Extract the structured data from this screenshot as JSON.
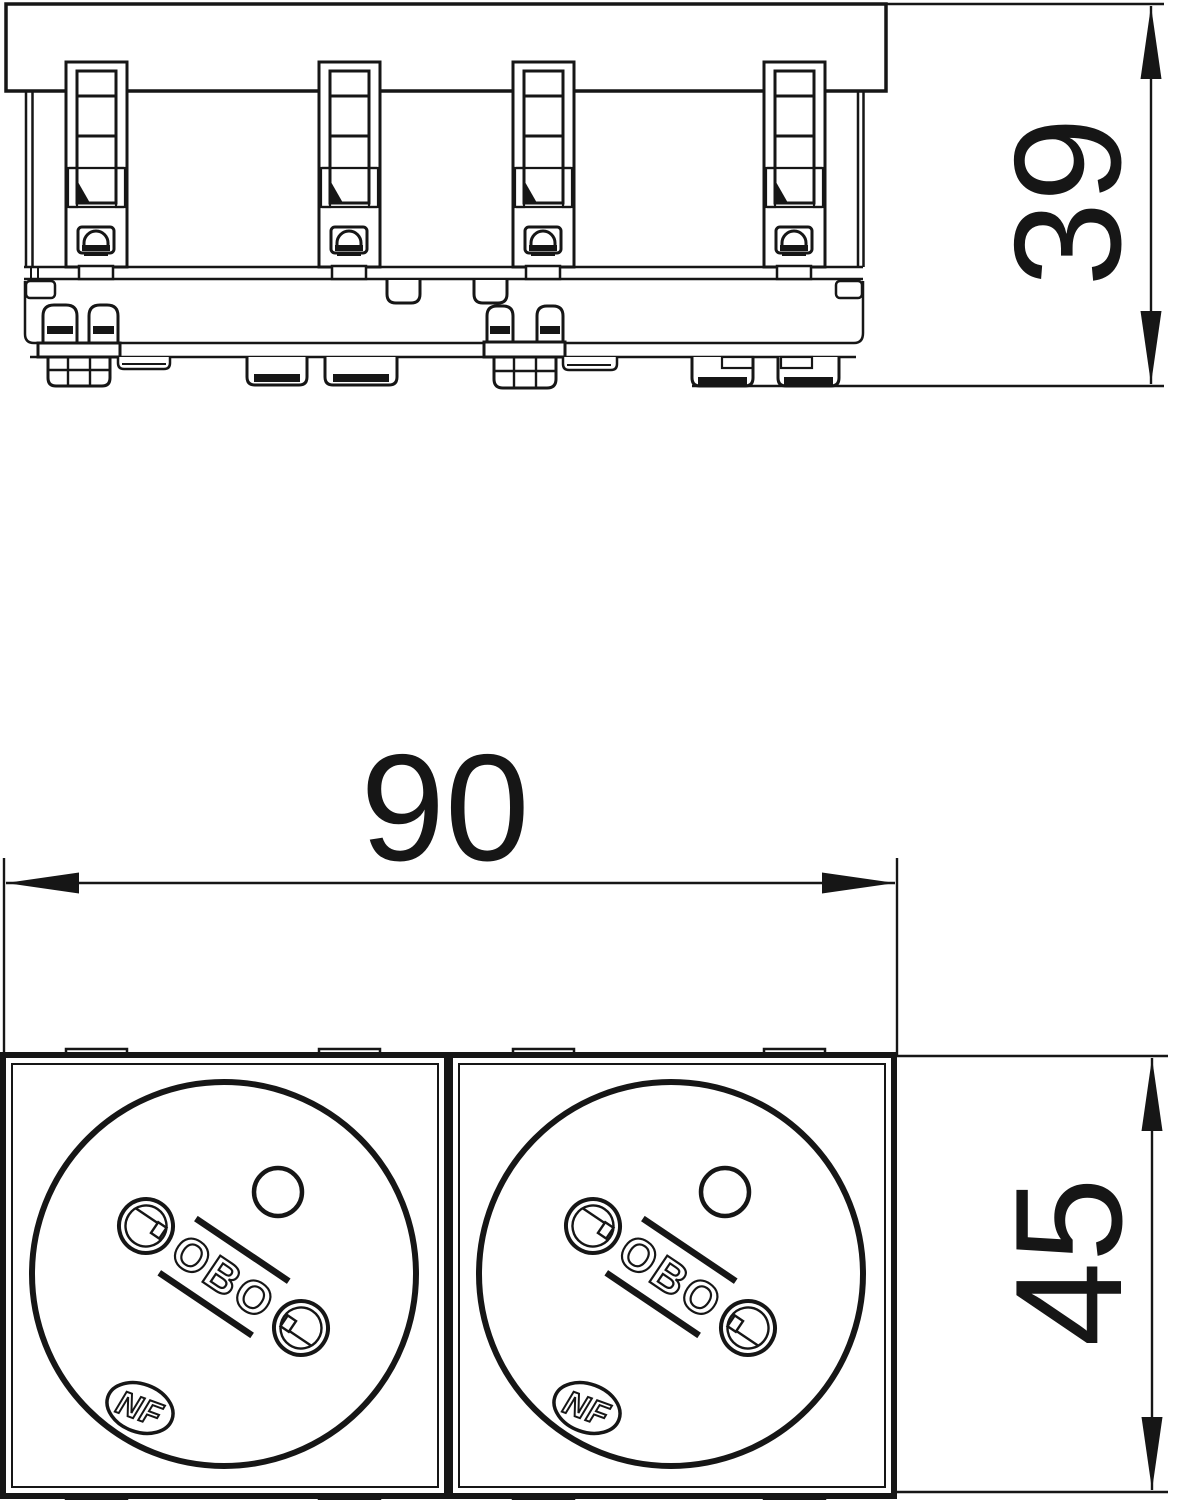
{
  "document": {
    "type": "technical dimension drawing",
    "background": "#ffffff",
    "line_color": "#161616"
  },
  "dimensions": [
    {
      "label": "39",
      "orientation": "vertical",
      "applies_to": "side view height"
    },
    {
      "label": "90",
      "orientation": "horizontal",
      "applies_to": "front view width"
    },
    {
      "label": "45",
      "orientation": "vertical",
      "applies_to": "front view height"
    }
  ],
  "front_view": {
    "modules": [
      {
        "brand_logo": "OBO",
        "certification_mark": "NF"
      },
      {
        "brand_logo": "OBO",
        "certification_mark": "NF"
      }
    ]
  }
}
